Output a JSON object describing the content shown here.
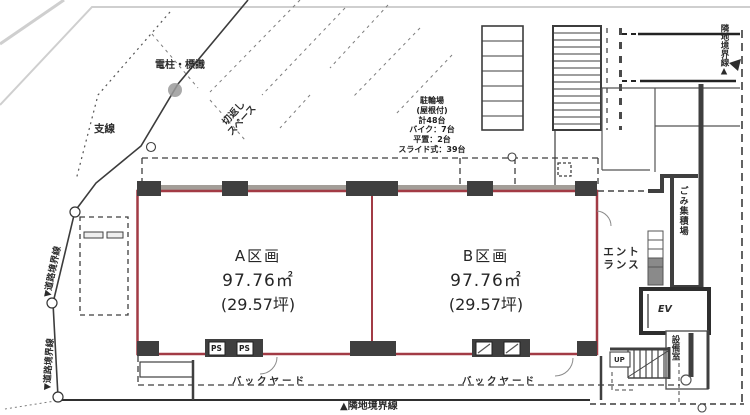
{
  "plan_type": "floor-plan",
  "colors": {
    "unit_outline_red": "#a23b45",
    "wall_dark": "#3f3f3f",
    "wall_gray": "#a39e98",
    "scan_gray": "#cfcfcf",
    "ink": "#333333"
  },
  "site": {
    "pole_sign_label": "電柱・標識",
    "branch_wire_label": "支線",
    "turnaround_label_line1": "切返し",
    "turnaround_label_line2": "スペース",
    "road_boundary_upper_label": "▼道路境界線",
    "road_boundary_lower_label": "▼道路境界線",
    "neighbor_boundary_right_label": "隣地境界線▲",
    "neighbor_boundary_bottom_label": "▲隣地境界線"
  },
  "bike_parking": {
    "lines": [
      "駐輪場",
      "(屋根付)",
      "計48台",
      "バイク：7台",
      "平置：2台",
      "スライド式：39台"
    ]
  },
  "units": [
    {
      "name": "A区画",
      "area_sqm": "97.76㎡",
      "area_tsubo": "(29.57坪)"
    },
    {
      "name": "B区画",
      "area_sqm": "97.76㎡",
      "area_tsubo": "(29.57坪)"
    }
  ],
  "building": {
    "entrance_label_line1": "エント",
    "entrance_label_line2": "ランス",
    "garbage_label": "ごみ集積場",
    "elevator_label": "EV",
    "equipment_label": "設備室",
    "stairs_label": "UP",
    "ps_label": "PS",
    "backyard_label_a": "バックヤード",
    "backyard_label_b": "バックヤード"
  }
}
